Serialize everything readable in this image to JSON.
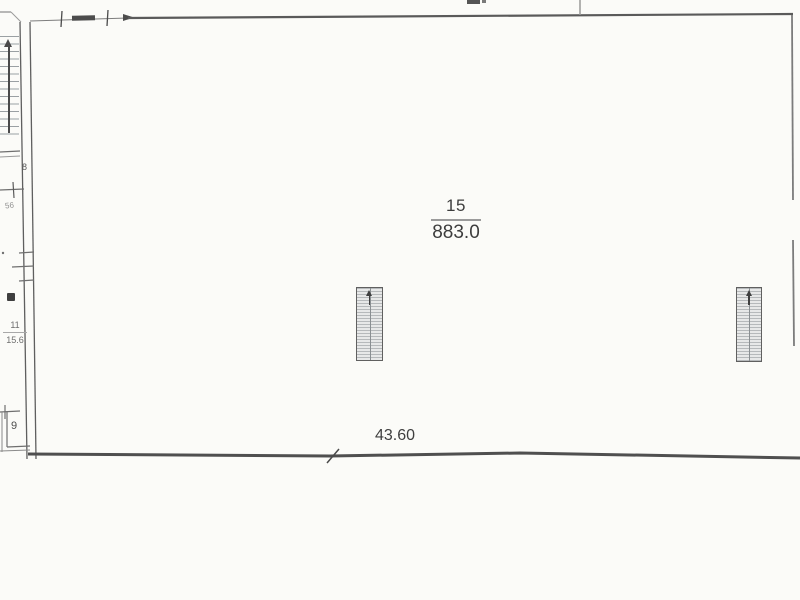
{
  "plan": {
    "main_room": {
      "number": "15",
      "area": "883.0"
    },
    "bottom_dimension": "43.60",
    "left_wing": {
      "room_upper_label": "8",
      "small_dimension": "56",
      "room_mid": {
        "number": "11",
        "area": "15.6"
      },
      "room_lower_label": "9"
    },
    "colors": {
      "ink": "#3f3f3f",
      "wall": "#5a5a5a",
      "faded_line": "#6f6f6f",
      "hatch_stripe": "#b6b9bb",
      "paper": "#fbfbf8"
    }
  }
}
